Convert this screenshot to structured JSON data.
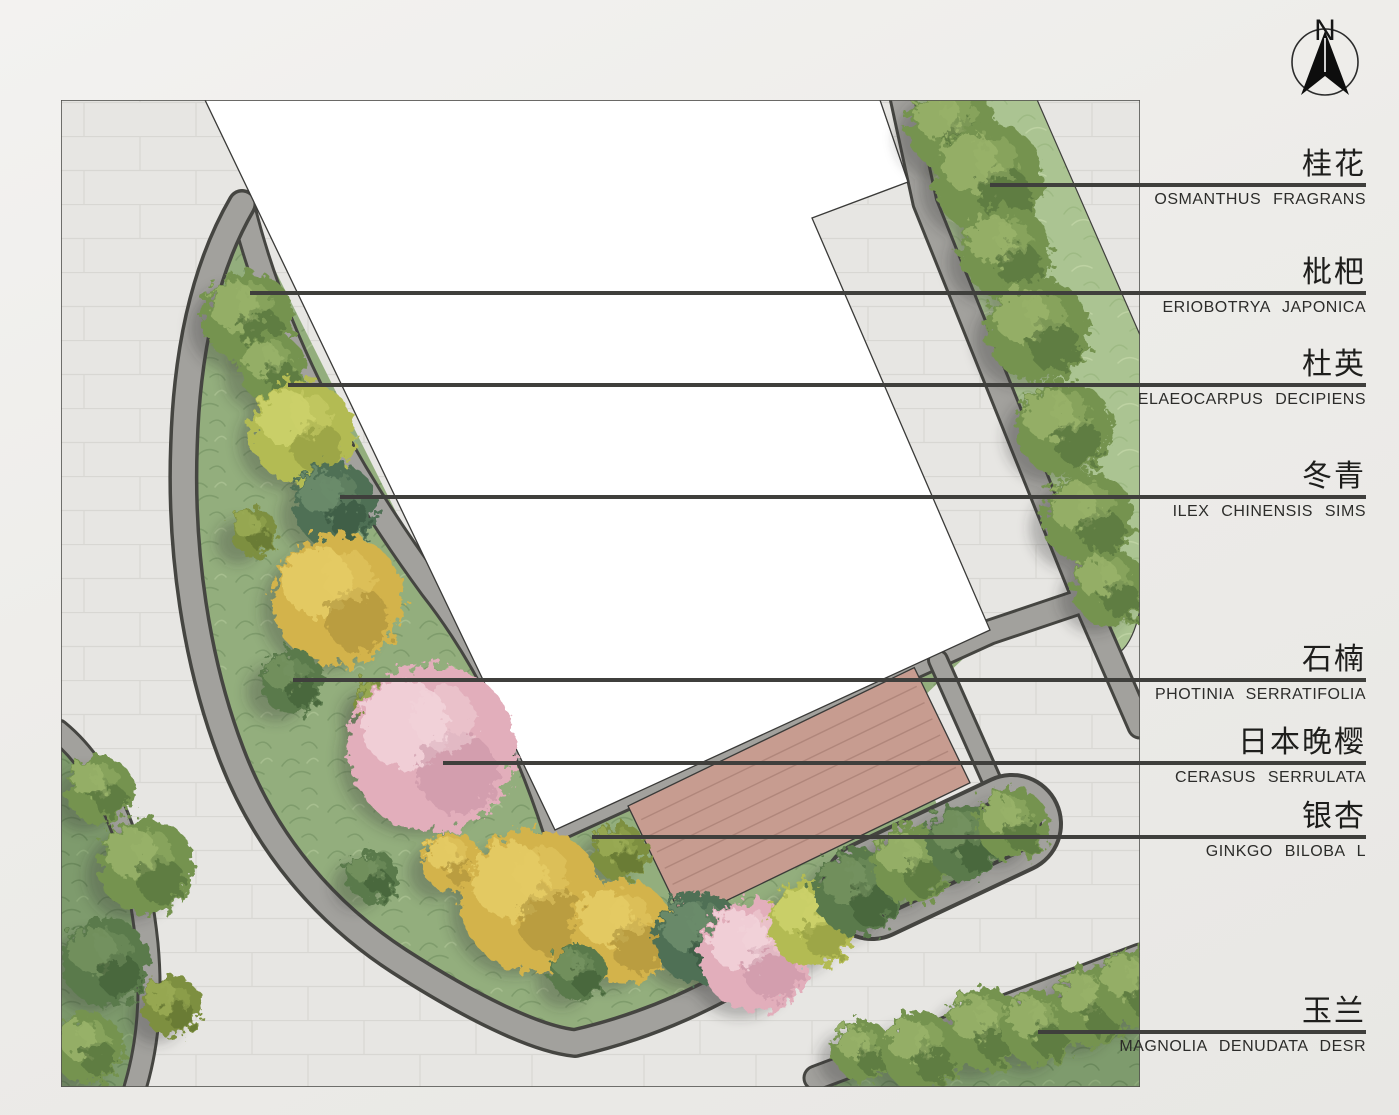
{
  "compass": {
    "letter": "N"
  },
  "legend": {
    "line_end_x": 1366,
    "plants": [
      {
        "cn": "桂花",
        "latin": "OSMANTHUS FRAGRANS",
        "line_y": 185,
        "tip_x": 990
      },
      {
        "cn": "枇杷",
        "latin": "ERIOBOTRYA JAPONICA",
        "line_y": 293,
        "tip_x": 250
      },
      {
        "cn": "杜英",
        "latin": "ELAEOCARPUS DECIPIENS",
        "line_y": 385,
        "tip_x": 288
      },
      {
        "cn": "冬青",
        "latin": "ILEX CHINENSIS SIMS",
        "line_y": 497,
        "tip_x": 340
      },
      {
        "cn": "石楠",
        "latin": "PHOTINIA SERRATIFOLIA",
        "line_y": 680,
        "tip_x": 293
      },
      {
        "cn": "日本晚樱",
        "latin": "CERASUS SERRULATA",
        "line_y": 763,
        "tip_x": 443
      },
      {
        "cn": "银杏",
        "latin": "GINKGO BILOBA L",
        "line_y": 837,
        "tip_x": 592
      },
      {
        "cn": "玉兰",
        "latin": "MAGNOLIA DENUDATA DESR",
        "line_y": 1032,
        "tip_x": 1038
      }
    ]
  },
  "colors": {
    "leader_line": "#3f3f3c",
    "label_text": "#1e1e1c",
    "latin_text": "#2c2c2a",
    "pavement": "#e7e6e3",
    "path_gray": "#a2a19d",
    "path_edge": "#454541",
    "bed_green": "#93ae7d",
    "strip_green": "#abc492",
    "dark_green_area": "#7e9b6d",
    "deck_brown": "#c79c90",
    "building_white": "#ffffff",
    "shadow": "#3b3b37"
  },
  "tree_types": {
    "green": {
      "base": "#74934f",
      "light": "#9ab36a",
      "dark": "#4e6b38"
    },
    "darkgreen": {
      "base": "#5a7a4c",
      "light": "#76935f",
      "dark": "#3c5733"
    },
    "teal": {
      "base": "#4f7055",
      "light": "#6d8d6d",
      "dark": "#35523c"
    },
    "yellow": {
      "base": "#d3b34c",
      "light": "#e5cc66",
      "dark": "#a68a38"
    },
    "yellowgreen": {
      "base": "#b3bb52",
      "light": "#cdd26b",
      "dark": "#8a963c"
    },
    "olive": {
      "base": "#7d8f3f",
      "light": "#9aab55",
      "dark": "#5c6e2e"
    },
    "pink": {
      "base": "#e2aebb",
      "light": "#f2d4da",
      "dark": "#c791a4"
    }
  },
  "trees": [
    [
      248,
      318,
      46,
      "green"
    ],
    [
      272,
      368,
      34,
      "green"
    ],
    [
      302,
      432,
      52,
      "yellowgreen"
    ],
    [
      254,
      532,
      24,
      "olive"
    ],
    [
      335,
      505,
      42,
      "teal"
    ],
    [
      338,
      600,
      66,
      "yellow"
    ],
    [
      292,
      682,
      32,
      "darkgreen"
    ],
    [
      382,
      706,
      28,
      "olive"
    ],
    [
      432,
      748,
      84,
      "pink"
    ],
    [
      372,
      876,
      26,
      "darkgreen"
    ],
    [
      452,
      862,
      30,
      "yellow"
    ],
    [
      532,
      900,
      72,
      "yellow"
    ],
    [
      622,
      932,
      52,
      "yellow"
    ],
    [
      620,
      852,
      28,
      "olive"
    ],
    [
      578,
      972,
      28,
      "darkgreen"
    ],
    [
      700,
      938,
      46,
      "teal"
    ],
    [
      756,
      956,
      56,
      "pink"
    ],
    [
      812,
      924,
      44,
      "yellowgreen"
    ],
    [
      858,
      892,
      44,
      "darkgreen"
    ],
    [
      912,
      864,
      40,
      "green"
    ],
    [
      964,
      842,
      38,
      "darkgreen"
    ],
    [
      1012,
      824,
      36,
      "green"
    ],
    [
      952,
      128,
      44,
      "green"
    ],
    [
      988,
      178,
      56,
      "green"
    ],
    [
      1006,
      252,
      46,
      "green"
    ],
    [
      1038,
      330,
      52,
      "green"
    ],
    [
      1064,
      428,
      48,
      "green"
    ],
    [
      1088,
      518,
      46,
      "green"
    ],
    [
      1110,
      588,
      38,
      "green"
    ],
    [
      862,
      1050,
      30,
      "green"
    ],
    [
      922,
      1052,
      40,
      "green"
    ],
    [
      986,
      1030,
      42,
      "green"
    ],
    [
      1040,
      1028,
      38,
      "green"
    ],
    [
      1092,
      1006,
      40,
      "green"
    ],
    [
      1136,
      988,
      40,
      "green"
    ],
    [
      100,
      790,
      34,
      "green"
    ],
    [
      146,
      866,
      48,
      "green"
    ],
    [
      106,
      962,
      44,
      "darkgreen"
    ],
    [
      172,
      1006,
      30,
      "olive"
    ],
    [
      88,
      1048,
      36,
      "green"
    ]
  ]
}
